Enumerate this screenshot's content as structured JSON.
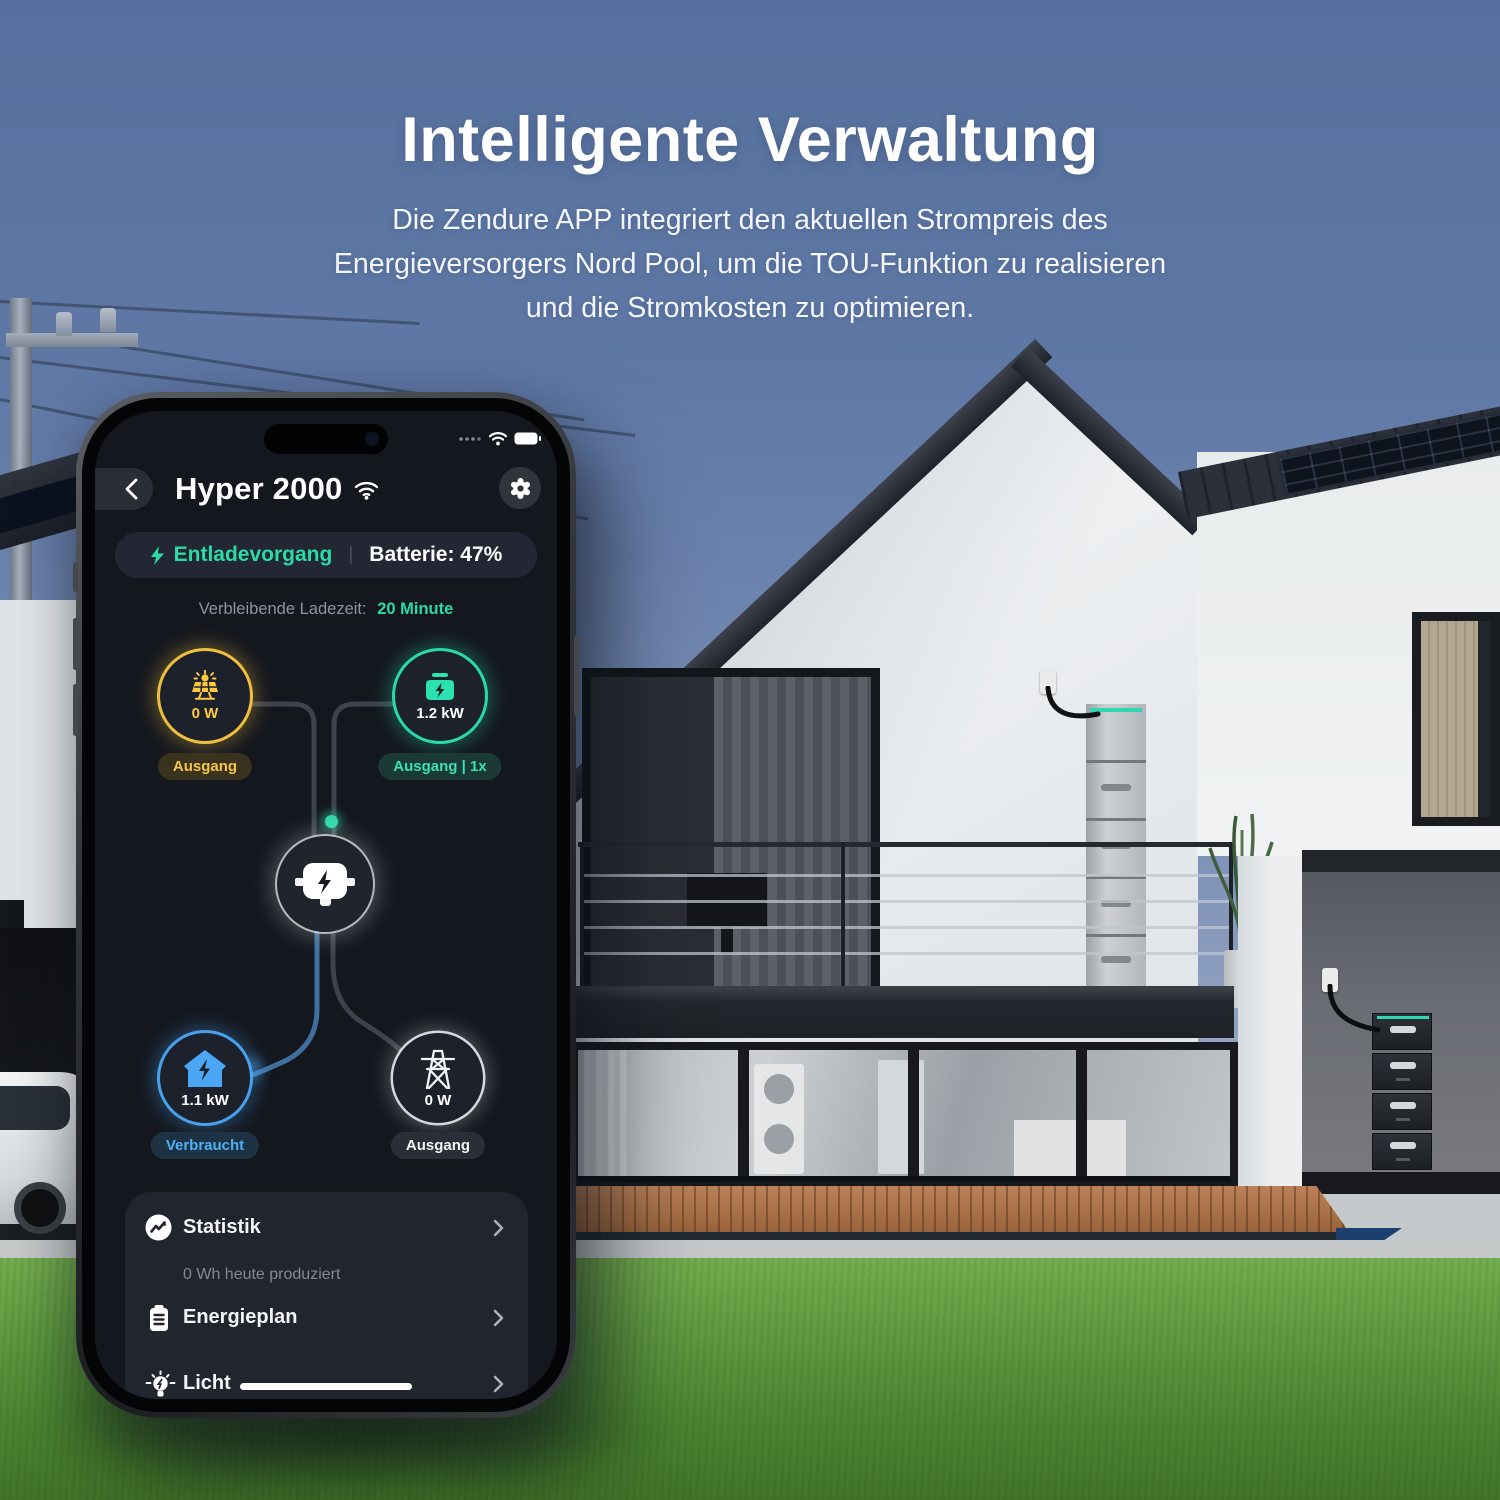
{
  "hero": {
    "title": "Intelligente Verwaltung",
    "subtitle_lines": [
      "Die Zendure APP integriert den aktuellen Strompreis des",
      "Energieversorgers Nord Pool, um die TOU-Funktion zu realisieren",
      "und die Stromkosten zu optimieren."
    ]
  },
  "phone": {
    "status_bar": {
      "signal_icon": "signal-dots-icon",
      "wifi_icon": "wifi-icon",
      "battery_icon": "battery-full-icon"
    },
    "header": {
      "back_icon": "chevron-left-icon",
      "title": "Hyper 2000",
      "wifi_icon": "wifi-icon",
      "settings_icon": "gear-icon"
    },
    "status_pill": {
      "bolt_icon": "lightning-icon",
      "mode": "Entladevorgang",
      "divider": "|",
      "battery": "Batterie: 47%"
    },
    "remaining": {
      "label": "Verbleibende Ladezeit:",
      "value": "20 Minute"
    },
    "flow": {
      "solar": {
        "icon": "solar-panel-icon",
        "value": "0 W",
        "badge": "Ausgang"
      },
      "battery": {
        "icon": "battery-icon",
        "value": "1.2 kW",
        "badge": "Ausgang | 1x"
      },
      "hub": {
        "icon": "power-hub-icon"
      },
      "home": {
        "icon": "house-bolt-icon",
        "value": "1.1 kW",
        "badge": "Verbraucht"
      },
      "grid": {
        "icon": "power-tower-icon",
        "value": "0 W",
        "badge": "Ausgang"
      }
    },
    "menu": [
      {
        "icon": "statistics-icon",
        "label": "Statistik",
        "sub": "0 Wh heute produziert"
      },
      {
        "icon": "energy-plan-icon",
        "label": "Energieplan"
      },
      {
        "icon": "light-icon",
        "label": "Licht"
      }
    ]
  },
  "colors": {
    "teal": "#2BD9A9",
    "yellow": "#FFC93F",
    "blue": "#4BA7F5",
    "screen_bg": "#15171E",
    "card_bg": "#21252E"
  }
}
